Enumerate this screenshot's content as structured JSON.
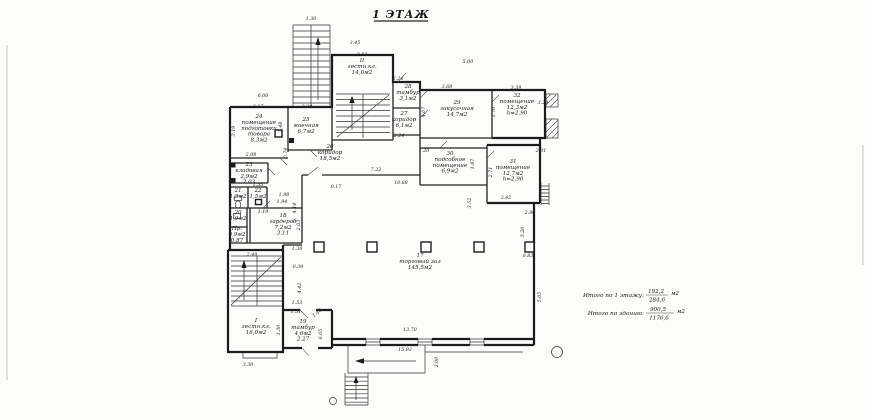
{
  "title": "1 ЭТАЖ",
  "summary": {
    "floor_label": "Итого по 1 этажу:",
    "floor_top": "192,2",
    "floor_bottom": "284,6",
    "floor_unit": "м2",
    "building_label": "Итого по зданию:",
    "building_top": "900,5",
    "building_bottom": "1176,6",
    "building_unit": "м2"
  },
  "rooms": [
    {
      "x": 259,
      "y": 118,
      "lines": [
        "24",
        "помещение",
        "подготовки",
        "товара",
        "8,3м2"
      ]
    },
    {
      "x": 306,
      "y": 121,
      "lines": [
        "25",
        "моечная",
        "6,7м2"
      ]
    },
    {
      "x": 362,
      "y": 62,
      "lines": [
        "II",
        "лестн.кл.",
        "14,0м2"
      ]
    },
    {
      "x": 408,
      "y": 88,
      "lines": [
        "28",
        "тамбур",
        "3,1м2"
      ]
    },
    {
      "x": 404,
      "y": 115,
      "lines": [
        "27",
        "коридор",
        "6,1м2"
      ]
    },
    {
      "x": 457,
      "y": 104,
      "lines": [
        "29",
        "закусочная",
        "14,7м2"
      ]
    },
    {
      "x": 517,
      "y": 97,
      "lines": [
        "32",
        "помещение",
        "12,3м2",
        "h=2.90"
      ]
    },
    {
      "x": 450,
      "y": 155,
      "lines": [
        "30",
        "подсобное",
        "помещение",
        "6,9м2"
      ]
    },
    {
      "x": 513,
      "y": 163,
      "lines": [
        "31",
        "помещение",
        "12,7м2",
        "h=2.90"
      ]
    },
    {
      "x": 330,
      "y": 148,
      "lines": [
        "26",
        "коридор",
        "18,5м2"
      ]
    },
    {
      "x": 249,
      "y": 166,
      "lines": [
        "23",
        "кладовая",
        "2,9м2",
        "2.03"
      ]
    },
    {
      "x": 238,
      "y": 192,
      "lines": [
        "21",
        "1,3м2"
      ]
    },
    {
      "x": 258,
      "y": 192,
      "lines": [
        "22",
        "1,5м2"
      ]
    },
    {
      "x": 238,
      "y": 214,
      "lines": [
        "20",
        "1,9м2"
      ]
    },
    {
      "x": 237,
      "y": 230,
      "lines": [
        "Пр.",
        "0,9м2",
        "0.87"
      ]
    },
    {
      "x": 283,
      "y": 217,
      "lines": [
        "18",
        "гардероб",
        "7,2м2",
        "3.11"
      ]
    },
    {
      "x": 420,
      "y": 257,
      "lines": [
        "17",
        "торговый зал",
        "145,5м2"
      ]
    },
    {
      "x": 256,
      "y": 322,
      "lines": [
        "I",
        "лестн.кл.",
        "16,0м2"
      ]
    },
    {
      "x": 303,
      "y": 323,
      "lines": [
        "19",
        "тамбур",
        "4,6м2",
        "2.27"
      ]
    }
  ],
  "dimensions": [
    {
      "t": "1.30",
      "x": 311,
      "y": 20
    },
    {
      "t": "3.45",
      "x": 355,
      "y": 44
    },
    {
      "t": "2.52",
      "x": 362,
      "y": 56
    },
    {
      "t": "5.00",
      "x": 468,
      "y": 63
    },
    {
      "t": "2.24",
      "x": 398,
      "y": 80
    },
    {
      "t": "3.68",
      "x": 447,
      "y": 88
    },
    {
      "t": "3.39",
      "x": 516,
      "y": 89
    },
    {
      "t": "3.29",
      "x": 543,
      "y": 104
    },
    {
      "t": "6.00",
      "x": 263,
      "y": 97
    },
    {
      "t": "3.17",
      "x": 258,
      "y": 108
    },
    {
      "t": "2.29",
      "x": 307,
      "y": 108
    },
    {
      "t": "3.19",
      "x": 235,
      "y": 131,
      "r": -90
    },
    {
      "t": "2.48",
      "x": 282,
      "y": 127,
      "r": -90
    },
    {
      "t": "2.08",
      "x": 251,
      "y": 156
    },
    {
      "t": "0.74",
      "x": 287,
      "y": 153,
      "r": -90
    },
    {
      "t": "1.20",
      "x": 424,
      "y": 152
    },
    {
      "t": "4.07",
      "x": 425,
      "y": 112,
      "r": -90
    },
    {
      "t": "1.70",
      "x": 495,
      "y": 112,
      "r": -90
    },
    {
      "t": "2.24",
      "x": 399,
      "y": 137
    },
    {
      "t": "7.22",
      "x": 376,
      "y": 171
    },
    {
      "t": "10.88",
      "x": 401,
      "y": 184
    },
    {
      "t": "0.17",
      "x": 336,
      "y": 188
    },
    {
      "t": "4.14",
      "x": 296,
      "y": 208,
      "r": -90
    },
    {
      "t": "1.87",
      "x": 474,
      "y": 164,
      "r": -90
    },
    {
      "t": "2.71",
      "x": 492,
      "y": 172,
      "r": -90
    },
    {
      "t": "3.42",
      "x": 506,
      "y": 199
    },
    {
      "t": "3.52",
      "x": 471,
      "y": 203,
      "r": -90
    },
    {
      "t": "2.01",
      "x": 541,
      "y": 152
    },
    {
      "t": "2.80",
      "x": 530,
      "y": 214
    },
    {
      "t": "3.20",
      "x": 524,
      "y": 232,
      "r": -90
    },
    {
      "t": "0.83",
      "x": 528,
      "y": 257
    },
    {
      "t": "5.05",
      "x": 541,
      "y": 297,
      "r": -90
    },
    {
      "t": "1.55",
      "x": 258,
      "y": 186
    },
    {
      "t": "1.98",
      "x": 284,
      "y": 196
    },
    {
      "t": "1.94",
      "x": 282,
      "y": 203
    },
    {
      "t": "1.19",
      "x": 263,
      "y": 213
    },
    {
      "t": "2.03",
      "x": 300,
      "y": 225,
      "r": -90
    },
    {
      "t": "1.38",
      "x": 297,
      "y": 250
    },
    {
      "t": "2.49",
      "x": 252,
      "y": 256
    },
    {
      "t": "0.39",
      "x": 298,
      "y": 268
    },
    {
      "t": "4.42",
      "x": 301,
      "y": 288,
      "r": -90
    },
    {
      "t": "1.30",
      "x": 280,
      "y": 330,
      "r": -90
    },
    {
      "t": "1.53",
      "x": 297,
      "y": 304
    },
    {
      "t": "1.51",
      "x": 296,
      "y": 313
    },
    {
      "t": "1.40",
      "x": 318,
      "y": 314,
      "r": -40
    },
    {
      "t": "6.05",
      "x": 322,
      "y": 334,
      "r": -90
    },
    {
      "t": "13.70",
      "x": 410,
      "y": 331
    },
    {
      "t": "15.93",
      "x": 405,
      "y": 351
    },
    {
      "t": "2.00",
      "x": 438,
      "y": 362,
      "r": -90
    },
    {
      "t": "3.30",
      "x": 248,
      "y": 366
    }
  ]
}
